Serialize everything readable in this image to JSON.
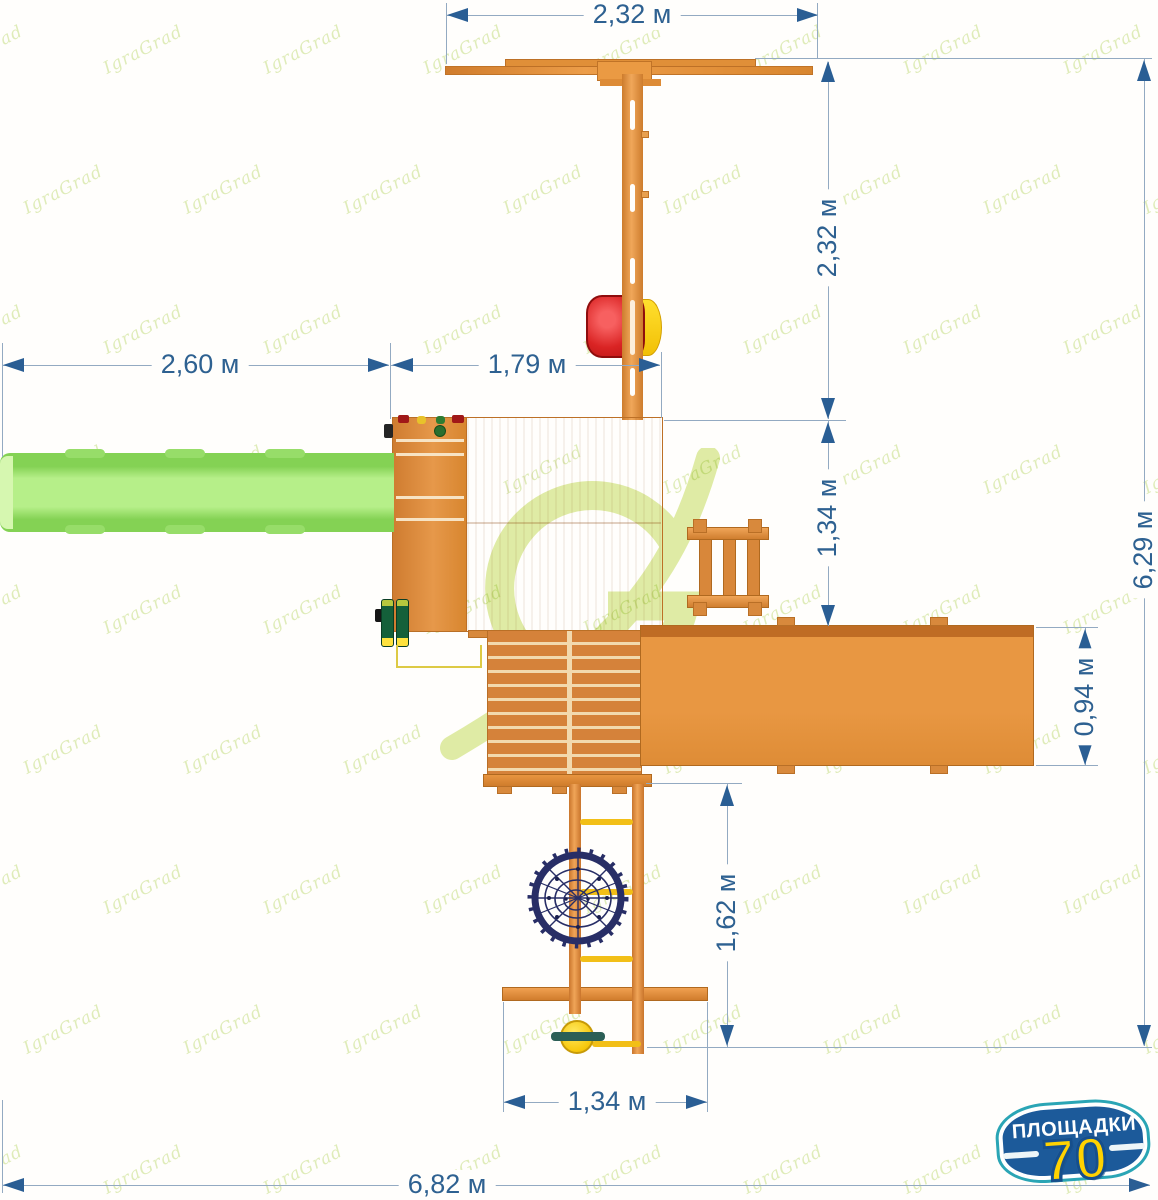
{
  "watermark": {
    "text": "IgraGrad",
    "center_letter": "G"
  },
  "dimensions": {
    "top_width": "2,32 м",
    "upper_height": "2,32 м",
    "left_width": "2,60 м",
    "platform_width": "1,79 м",
    "mid_height": "1,34 м",
    "right_deck_height": "0,94 м",
    "total_height": "6,29 м",
    "ladder_height": "1,62 м",
    "bottom_width": "1,34 м",
    "total_width": "6,82 м"
  },
  "badge": {
    "title": "ПЛОЩАДКИ",
    "number": "70"
  },
  "colors": {
    "dimension_text": "#2e6191",
    "dimension_arrow": "#2a5e94",
    "wood": "#e2903a",
    "slide_green": "#9ee06f",
    "seat_red": "#d82222",
    "seat_yellow": "#ffd60a",
    "net_navy": "#282e66",
    "rung_yellow": "#f2bf17",
    "badge_blue": "#1c5a9a",
    "badge_teal": "#2aa5b5",
    "badge_yellow": "#ffd200",
    "watermark_green": "#c4dc82"
  }
}
